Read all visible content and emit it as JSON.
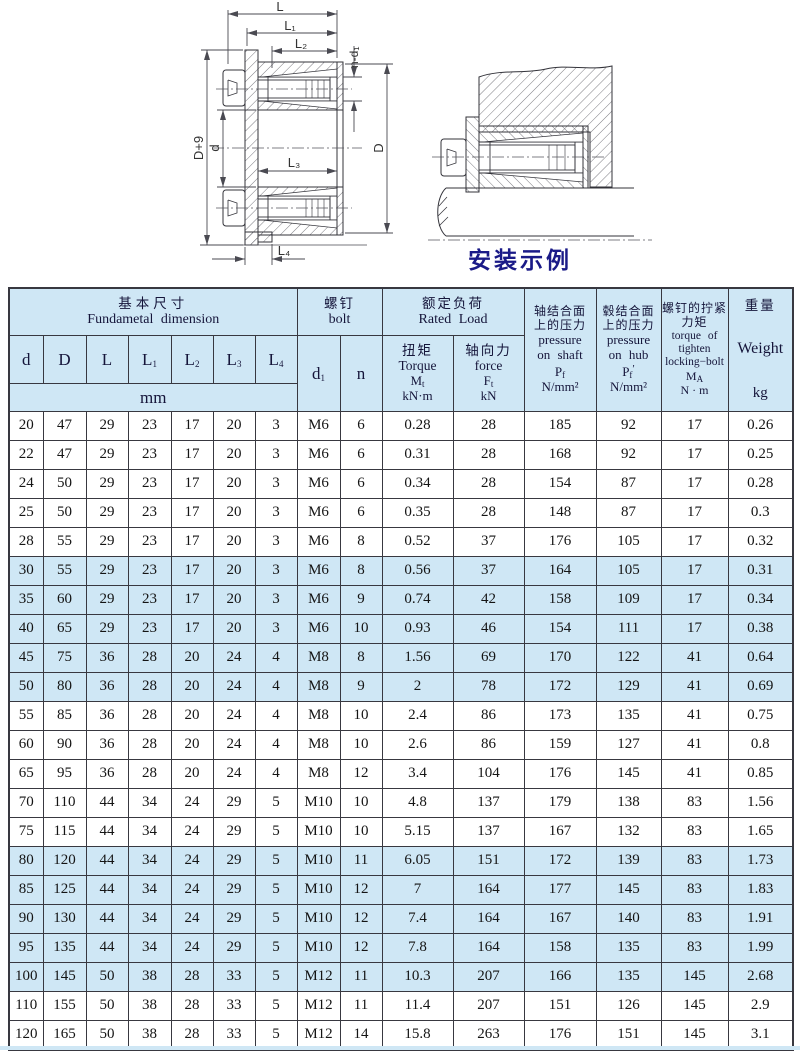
{
  "drawing": {
    "caption": "安装示例",
    "labels": {
      "L": "L",
      "L1": "L₁",
      "L2": "L₂",
      "L3": "L₃",
      "L4": "L₄",
      "d": "d",
      "D": "D",
      "D9": "D+9",
      "nd1": "n-d₁"
    }
  },
  "colors": {
    "band": "#cfe7f5",
    "border": "#383840",
    "caption": "#1a1a87"
  },
  "table": {
    "header": {
      "basic_cn": "基本尺寸",
      "basic_en": "Fundametal dimension",
      "bolt_cn": "螺钉",
      "bolt_en": "bolt",
      "rated_cn": "额定负荷",
      "rated_en": "Rated Load",
      "unit_mm": "mm",
      "cols": {
        "d": "d",
        "D": "D",
        "L": "L",
        "L1b": "L",
        "L1s": "1",
        "L2b": "L",
        "L2s": "2",
        "L3b": "L",
        "L3s": "3",
        "L4b": "L",
        "L4s": "4",
        "d1b": "d",
        "d1s": "1",
        "n": "n"
      },
      "torque": {
        "cn": "扭矩",
        "en": "Torque",
        "symb": "M",
        "syms": "t",
        "unit": "kN·m"
      },
      "force": {
        "cn": "轴向力",
        "en": "force",
        "symb": "F",
        "syms": "t",
        "unit": "kN"
      },
      "pshaft": {
        "cn1": "轴结合面",
        "cn2": "上的压力",
        "en1": "pressure",
        "en2": "on shaft",
        "symb": "P",
        "syms": "f",
        "prime": "",
        "unit": "N/mm²"
      },
      "phub": {
        "cn1": "毂结合面",
        "cn2": "上的压力",
        "en1": "pressure",
        "en2": "on hub",
        "symb": "P",
        "syms": "f",
        "prime": "′",
        "unit": "N/mm²"
      },
      "ma": {
        "cn1": "螺钉的拧紧",
        "cn2": "力矩",
        "en1": "torque of",
        "en2": "tighten",
        "en3": "locking−bolt",
        "symb": "M",
        "syms": "A",
        "unit": "N · m"
      },
      "weight": {
        "cn": "重量",
        "en": "Weight",
        "unit": "kg"
      }
    },
    "rows": [
      [
        "20",
        "47",
        "29",
        "23",
        "17",
        "20",
        "3",
        "M6",
        "6",
        "0.28",
        "28",
        "185",
        "92",
        "17",
        "0.26"
      ],
      [
        "22",
        "47",
        "29",
        "23",
        "17",
        "20",
        "3",
        "M6",
        "6",
        "0.31",
        "28",
        "168",
        "92",
        "17",
        "0.25"
      ],
      [
        "24",
        "50",
        "29",
        "23",
        "17",
        "20",
        "3",
        "M6",
        "6",
        "0.34",
        "28",
        "154",
        "87",
        "17",
        "0.28"
      ],
      [
        "25",
        "50",
        "29",
        "23",
        "17",
        "20",
        "3",
        "M6",
        "6",
        "0.35",
        "28",
        "148",
        "87",
        "17",
        "0.3"
      ],
      [
        "28",
        "55",
        "29",
        "23",
        "17",
        "20",
        "3",
        "M6",
        "8",
        "0.52",
        "37",
        "176",
        "105",
        "17",
        "0.32"
      ],
      [
        "30",
        "55",
        "29",
        "23",
        "17",
        "20",
        "3",
        "M6",
        "8",
        "0.56",
        "37",
        "164",
        "105",
        "17",
        "0.31"
      ],
      [
        "35",
        "60",
        "29",
        "23",
        "17",
        "20",
        "3",
        "M6",
        "9",
        "0.74",
        "42",
        "158",
        "109",
        "17",
        "0.34"
      ],
      [
        "40",
        "65",
        "29",
        "23",
        "17",
        "20",
        "3",
        "M6",
        "10",
        "0.93",
        "46",
        "154",
        "111",
        "17",
        "0.38"
      ],
      [
        "45",
        "75",
        "36",
        "28",
        "20",
        "24",
        "4",
        "M8",
        "8",
        "1.56",
        "69",
        "170",
        "122",
        "41",
        "0.64"
      ],
      [
        "50",
        "80",
        "36",
        "28",
        "20",
        "24",
        "4",
        "M8",
        "9",
        "2",
        "78",
        "172",
        "129",
        "41",
        "0.69"
      ],
      [
        "55",
        "85",
        "36",
        "28",
        "20",
        "24",
        "4",
        "M8",
        "10",
        "2.4",
        "86",
        "173",
        "135",
        "41",
        "0.75"
      ],
      [
        "60",
        "90",
        "36",
        "28",
        "20",
        "24",
        "4",
        "M8",
        "10",
        "2.6",
        "86",
        "159",
        "127",
        "41",
        "0.8"
      ],
      [
        "65",
        "95",
        "36",
        "28",
        "20",
        "24",
        "4",
        "M8",
        "12",
        "3.4",
        "104",
        "176",
        "145",
        "41",
        "0.85"
      ],
      [
        "70",
        "110",
        "44",
        "34",
        "24",
        "29",
        "5",
        "M10",
        "10",
        "4.8",
        "137",
        "179",
        "138",
        "83",
        "1.56"
      ],
      [
        "75",
        "115",
        "44",
        "34",
        "24",
        "29",
        "5",
        "M10",
        "10",
        "5.15",
        "137",
        "167",
        "132",
        "83",
        "1.65"
      ],
      [
        "80",
        "120",
        "44",
        "34",
        "24",
        "29",
        "5",
        "M10",
        "11",
        "6.05",
        "151",
        "172",
        "139",
        "83",
        "1.73"
      ],
      [
        "85",
        "125",
        "44",
        "34",
        "24",
        "29",
        "5",
        "M10",
        "12",
        "7",
        "164",
        "177",
        "145",
        "83",
        "1.83"
      ],
      [
        "90",
        "130",
        "44",
        "34",
        "24",
        "29",
        "5",
        "M10",
        "12",
        "7.4",
        "164",
        "167",
        "140",
        "83",
        "1.91"
      ],
      [
        "95",
        "135",
        "44",
        "34",
        "24",
        "29",
        "5",
        "M10",
        "12",
        "7.8",
        "164",
        "158",
        "135",
        "83",
        "1.99"
      ],
      [
        "100",
        "145",
        "50",
        "38",
        "28",
        "33",
        "5",
        "M12",
        "11",
        "10.3",
        "207",
        "166",
        "135",
        "145",
        "2.68"
      ],
      [
        "110",
        "155",
        "50",
        "38",
        "28",
        "33",
        "5",
        "M12",
        "11",
        "11.4",
        "207",
        "151",
        "126",
        "145",
        "2.9"
      ],
      [
        "120",
        "165",
        "50",
        "38",
        "28",
        "33",
        "5",
        "M12",
        "14",
        "15.8",
        "263",
        "176",
        "151",
        "145",
        "3.1"
      ]
    ],
    "shaded_first_col": [
      "30",
      "35",
      "40",
      "45",
      "50",
      "80",
      "85",
      "90",
      "95",
      "100"
    ]
  }
}
